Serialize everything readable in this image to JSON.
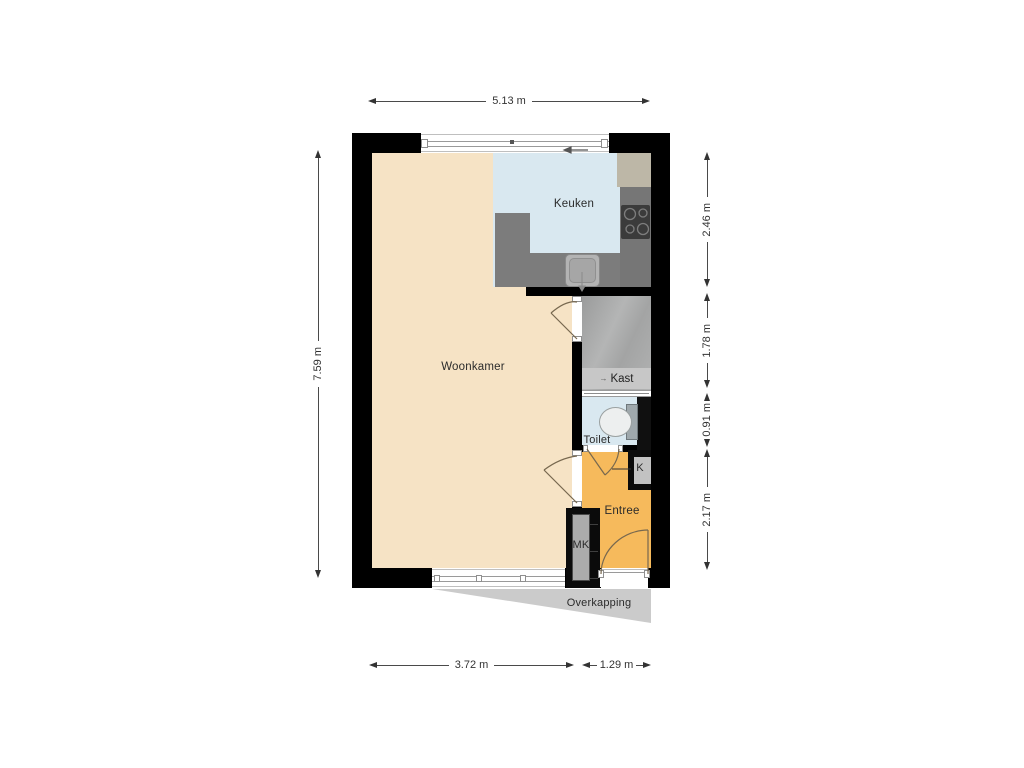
{
  "floorplan": {
    "rooms": [
      {
        "id": "woonkamer",
        "label": "Woonkamer"
      },
      {
        "id": "keuken",
        "label": "Keuken"
      },
      {
        "id": "kast",
        "label": "Kast"
      },
      {
        "id": "toilet",
        "label": "Toilet"
      },
      {
        "id": "entree",
        "label": "Entree"
      },
      {
        "id": "meterkast",
        "label": "MK"
      },
      {
        "id": "closet-k",
        "label": "K"
      },
      {
        "id": "overkapping",
        "label": "Overkapping"
      }
    ],
    "kast_direction_arrow": "→",
    "dimensions": {
      "top_width": "5.13 m",
      "left_height": "7.59 m",
      "right_segments": [
        "2.46 m",
        "1.78 m",
        "0.91 m",
        "2.17 m"
      ],
      "bottom_segments": [
        "3.72 m",
        "1.29 m"
      ]
    },
    "colors": {
      "wall": "#000000",
      "woonkamer_floor": "#F6E3C5",
      "keuken_floor": "#D9E8F0",
      "toilet_floor": "#D9E8F0",
      "entree_floor": "#F6BA5C",
      "counter": "#7C7C7C",
      "stairs_closet": "#ABACAC",
      "kast_band": "#C7C7C7",
      "overkapping": "#CBCBCB",
      "cooktop": "#3B3B3B"
    }
  }
}
